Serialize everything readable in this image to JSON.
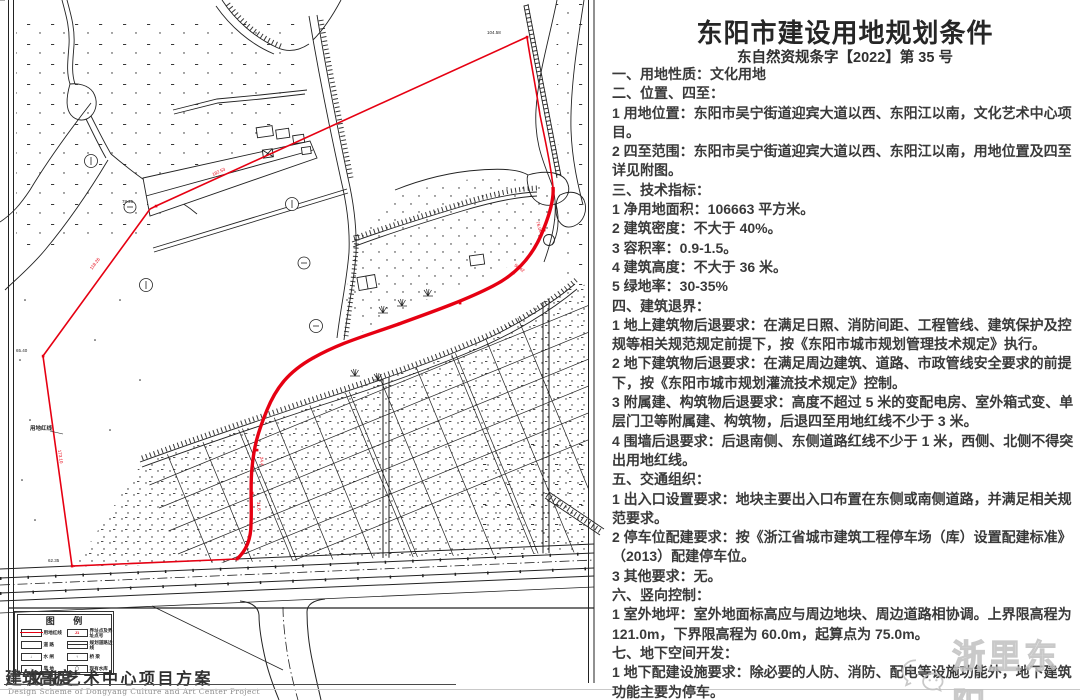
{
  "document": {
    "title": "东阳市建设用地规划条件",
    "doc_number": "东自然资规条字【2022】第 35 号",
    "paragraphs": [
      "一、用地性质：文化用地",
      "二、位置、四至：",
      "1 用地位置：东阳市吴宁街道迎宾大道以西、东阳江以南，文化艺术中心项目。",
      "2 四至范围：东阳市吴宁街道迎宾大道以西、东阳江以南，用地位置及四至详见附图。",
      "三、技术指标：",
      "1 净用地面积：106663 平方米。",
      "2 建筑密度：不大于 40%。",
      "3 容积率：0.9-1.5。",
      "4 建筑高度：不大于 36 米。",
      "5 绿地率：30-35%",
      "四、建筑退界：",
      "1 地上建筑物后退要求：在满足日照、消防间距、工程管线、建筑保护及控规等相关规范规定前提下，按《东阳市城市规划管理技术规定》执行。",
      "2 地下建筑物后退要求：在满足周边建筑、道路、市政管线安全要求的前提下，按《东阳市城市规划灌流技术规定》控制。",
      "3 附属建、构筑物后退要求：高度不超过 5 米的变配电房、室外箱式变、单层门卫等附属建、构筑物，后退四至用地红线不少于 3 米。",
      "4 围墙后退要求：后退南侧、东侧道路红线不少于 1 米，西侧、北侧不得突出用地红线。",
      "五、交通组织：",
      "1 出入口设置要求：地块主要出入口布置在东侧或南侧道路，并满足相关规范要求。",
      "2 停车位配建要求：按《浙江省城市建筑工程停车场（库）设置配建标准》（2013）配建停车位。",
      "3 其他要求：无。",
      "六、竖向控制：",
      "1 室外地坪：室外地面标高应与周边地块、周边道路相协调。上界限高程为 121.0m，下界限高程为 60.0m，起算点为 75.0m。",
      "七、地下空间开发：",
      "1 地下配建设施要求：除必要的人防、消防、配电等设施功能外，地下建筑功能主要为停车。",
      "2 其他要求：无"
    ]
  },
  "map": {
    "red_line_label": "用地红线",
    "labels": {
      "dim_top": "182.53",
      "dim_left_upper": "118.26",
      "dim_left": "173.10",
      "dim_arc1": "76.06",
      "dim_arc2": "58.42",
      "dim_arc3": "24.4",
      "dim_arc4": "31.8",
      "pt_a": "104.58",
      "pt_b": "78.25",
      "pt_w": "65.40",
      "pt_e": "62.35"
    },
    "legend": {
      "title": "图  例",
      "sym_point": "J1",
      "sym_bridge": "↓",
      "sym_sluice": "↑",
      "sym_dry": "·",
      "sym_res": "〇",
      "items": [
        "用地红线",
        "界址点及界址点号",
        "道 路",
        "规划道路边线",
        "水 闸",
        "桥 梁",
        "旱 地",
        "现有水库"
      ]
    },
    "caption_overlay": "建筑高度",
    "caption": "文化艺术中心项目方案",
    "caption_en": "Design Scheme of Dongyang Culture and Art Center Project"
  },
  "watermark": {
    "text": "浙里东阳"
  },
  "colors": {
    "red": "#e60012",
    "ink": "#1f1f1f",
    "separator": "#c9c9c9",
    "watermark": "#c0c0c0"
  }
}
